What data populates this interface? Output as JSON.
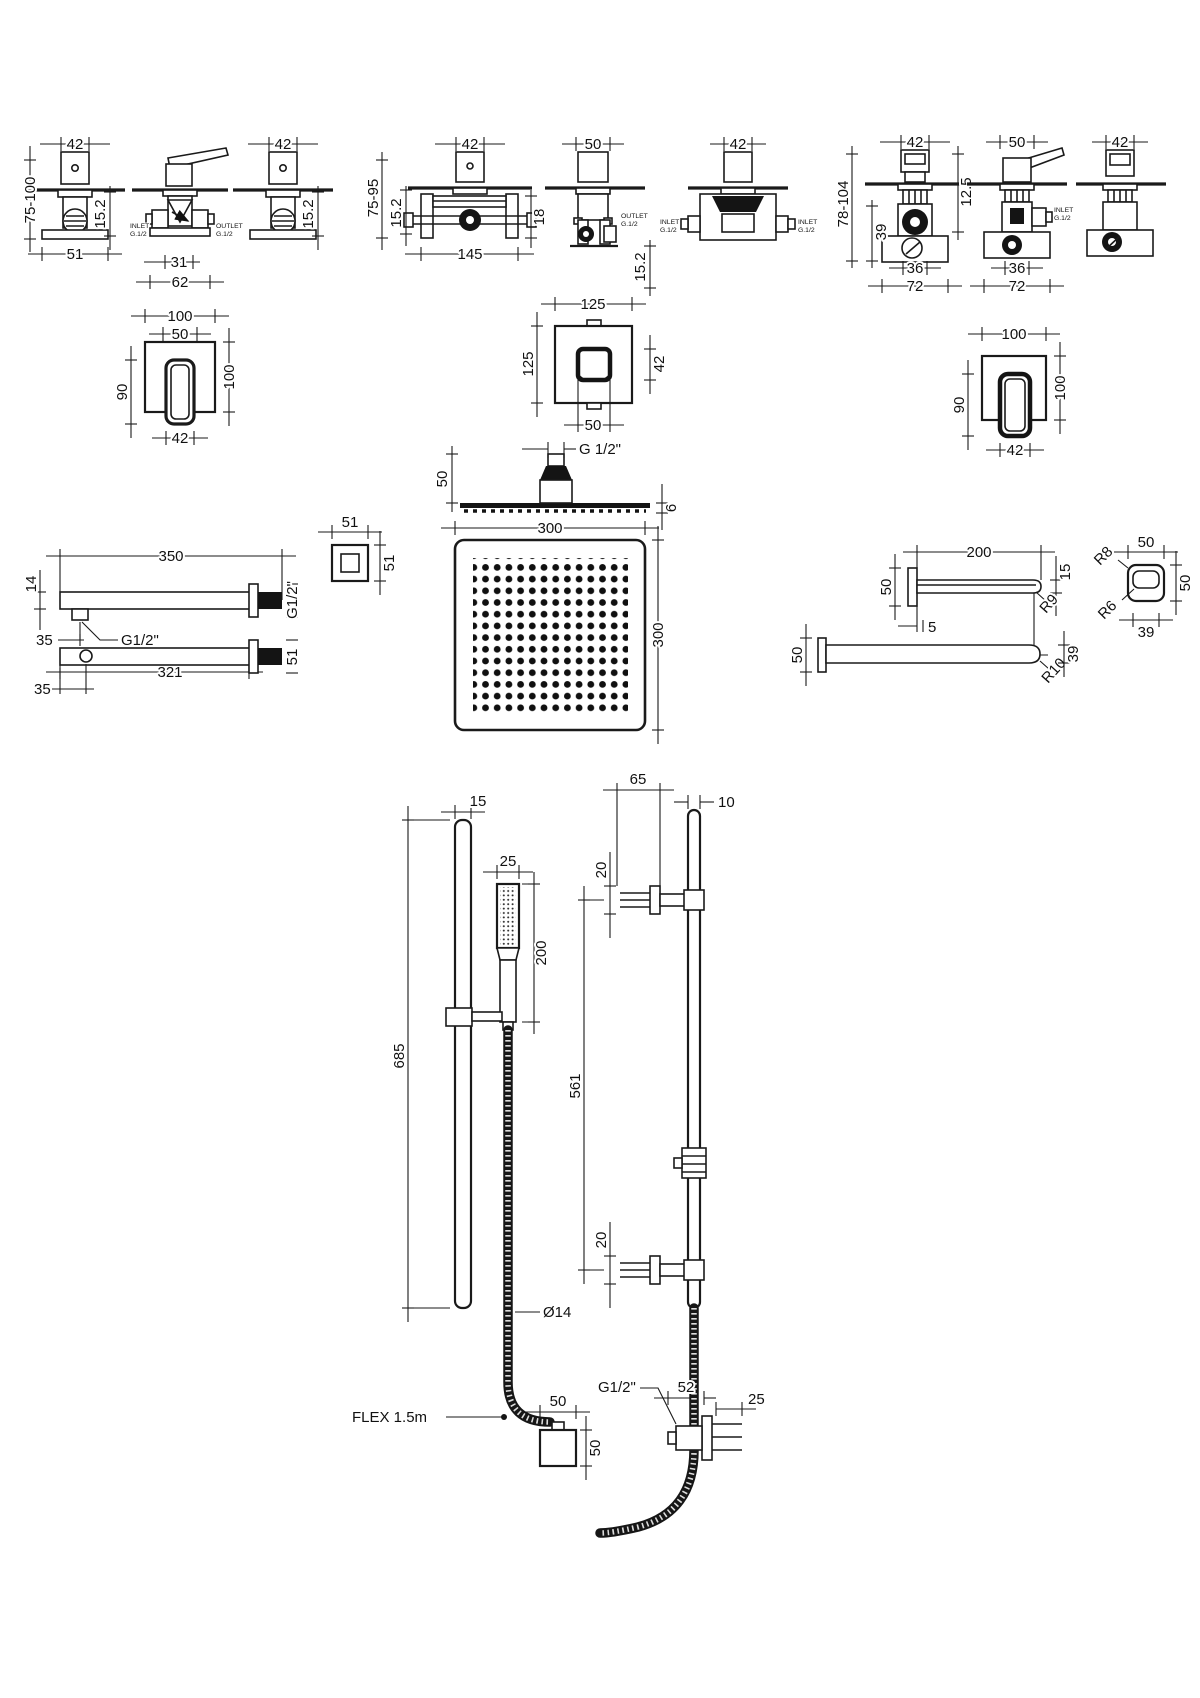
{
  "sheet_title": "shower-system-technical-drawing",
  "valves": {
    "a1": {
      "width": "42",
      "depth": "75-100",
      "panel": "15.2",
      "base": "51"
    },
    "a2": {
      "inlet1": "INLET",
      "inlet2": "G.1/2",
      "outlet1": "OUTLET",
      "outlet2": "G.1/2",
      "dim_inner": "31",
      "dim_outer": "62"
    },
    "a3": {
      "width": "42",
      "panel": "15.2"
    },
    "b1": {
      "width": "42",
      "depth": "75-95",
      "panel": "15.2",
      "side": "18",
      "base": "145"
    },
    "b2": {
      "width": "50",
      "outlet1": "OUTLET",
      "outlet2": "G.1/2",
      "panel": "15.2"
    },
    "b3": {
      "width": "42",
      "inlet_l1": "INLET",
      "inlet_l2": "G.1/2",
      "inlet_r1": "INLET",
      "inlet_r2": "G.1/2"
    },
    "c1": {
      "width": "42",
      "depth": "78-104",
      "offset": "39",
      "panel": "12.5",
      "base_inner": "36",
      "base": "72"
    },
    "c2": {
      "width": "50",
      "inlet1": "INLET",
      "inlet2": "G.1/2",
      "base_inner": "36",
      "base": "72"
    },
    "c3": {
      "width": "42"
    }
  },
  "plates": {
    "p1": {
      "width": "100",
      "inner": "50",
      "handle_h": "90",
      "height": "100",
      "handle_w": "42"
    },
    "p2": {
      "width": "125",
      "height": "125",
      "knob": "42",
      "inner": "50"
    },
    "p3": {
      "width": "100",
      "handle_h": "90",
      "height": "100",
      "handle_w": "42"
    }
  },
  "head": {
    "thread": "G 1/2\"",
    "mount_h": "50",
    "thickness": "6",
    "width": "300",
    "height": "300"
  },
  "arm_left": {
    "length": "350",
    "drop": "14",
    "tab_offset": "35",
    "thread": "G1/2\"",
    "length_lower": "321",
    "thread_out": "G1/2\"",
    "end_w": "51",
    "end_h": "51",
    "flange": "51",
    "hole_offset": "35"
  },
  "arm_right": {
    "length": "200",
    "flange": "50",
    "tip": "15",
    "tip_radius": "R9",
    "plate": "5",
    "length_lower": "180",
    "end_w": "50",
    "end_h": "50",
    "r_outer": "R8",
    "r_inner": "R6",
    "end_inner": "39",
    "flange2": "50",
    "bend_radius": "R10",
    "bar_h": "39"
  },
  "rail_left": {
    "rail_w": "15",
    "length": "685",
    "handset_w": "25",
    "handset_l": "200",
    "hose_dia": "Ø14",
    "flex": "FLEX 1.5m",
    "outlet_w": "50",
    "outlet_h": "50"
  },
  "rail_right": {
    "bracket_reach": "65",
    "rail_w": "10",
    "bracket_top": "20",
    "span": "561",
    "bracket_bottom": "20",
    "elbow_w": "52",
    "elbow_d": "25",
    "thread": "G1/2\""
  }
}
